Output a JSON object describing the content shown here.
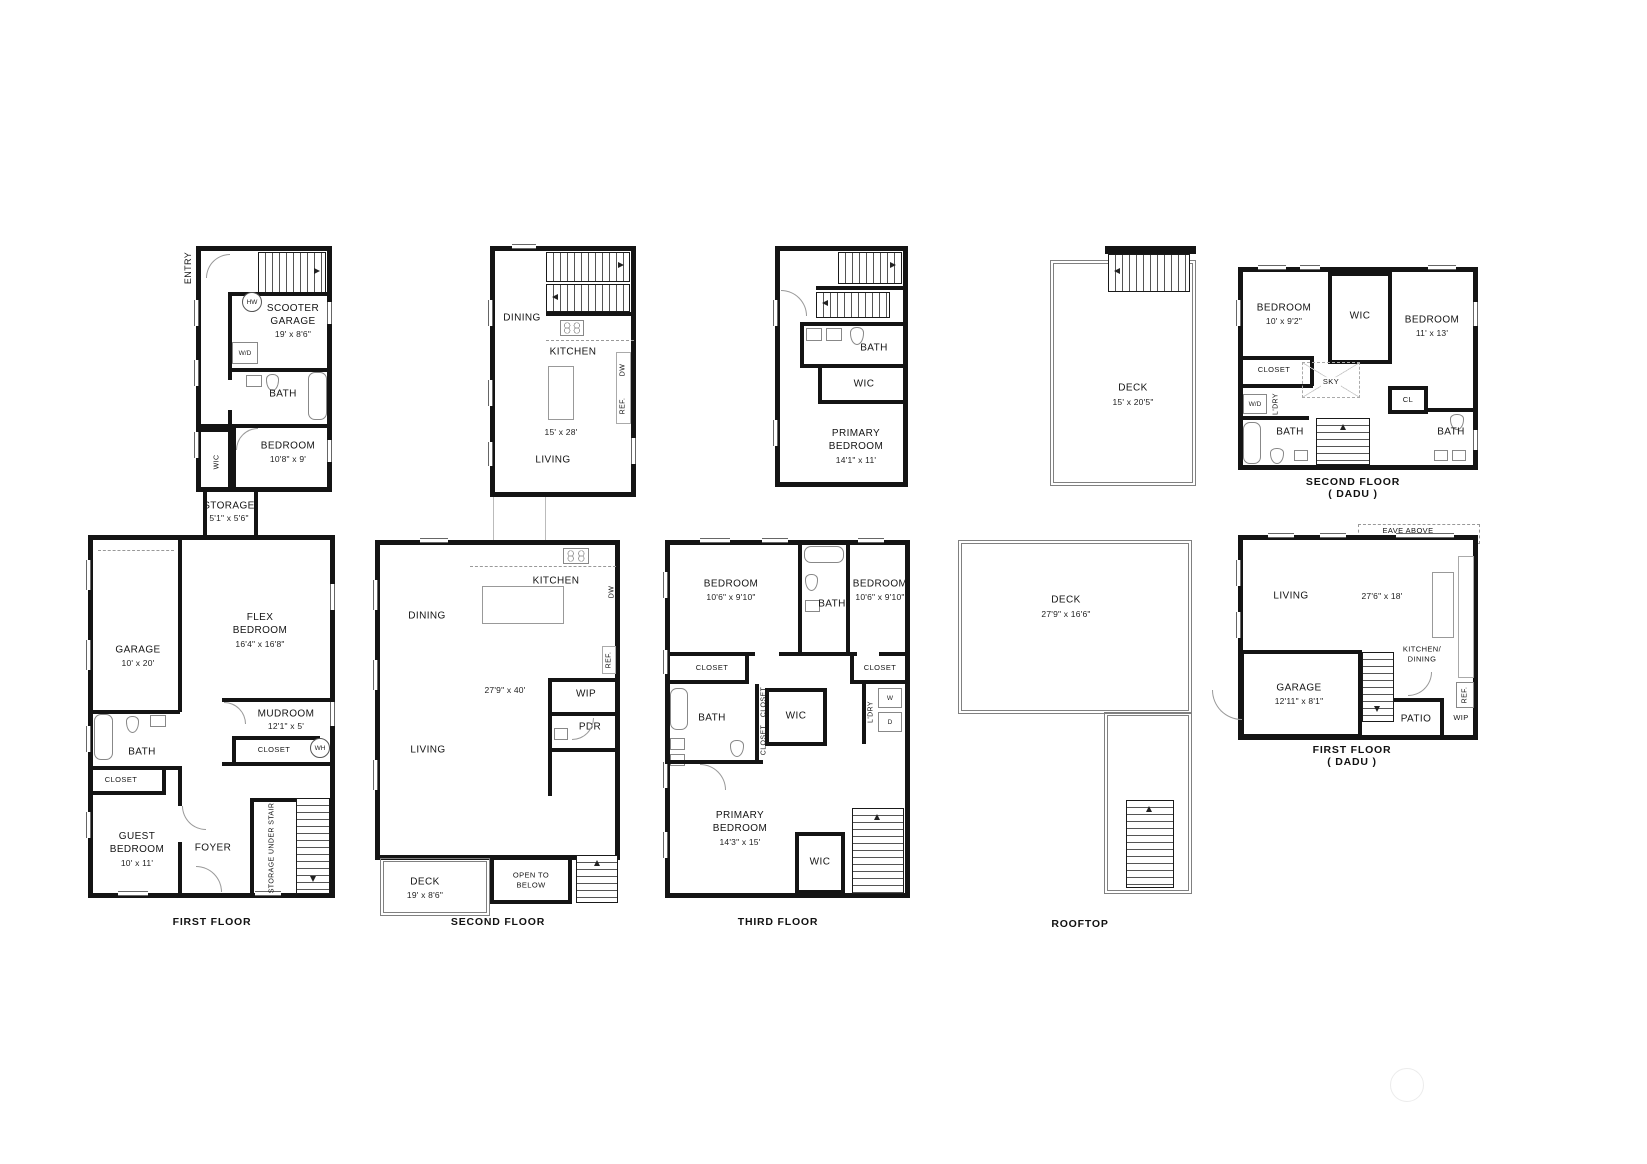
{
  "style": {
    "paper": "#ffffff",
    "ink": "#141414"
  },
  "plans": {
    "first_floor": {
      "caption": "FIRST FLOOR",
      "entry": "ENTRY",
      "hw": "HW",
      "scooter_garage": "SCOOTER GARAGE",
      "scooter_garage_dim": "19' x 8'6\"",
      "wd": "W/D",
      "bath_upper": "BATH",
      "bedroom": "BEDROOM",
      "bedroom_dim": "10'8\" x 9'",
      "wic": "WIC",
      "storage": "STORAGE",
      "storage_dim": "5'1\" x 5'6\"",
      "garage": "GARAGE",
      "garage_dim": "10' x 20'",
      "flex_bedroom": "FLEX BEDROOM",
      "flex_bedroom_dim": "16'4\" x 16'8\"",
      "mudroom": "MUDROOM",
      "mudroom_dim": "12'1\" x 5'",
      "mudroom_closet": "CLOSET",
      "wh": "WH",
      "bath_lower": "BATH",
      "guest_closet": "CLOSET",
      "guest_bedroom": "GUEST BEDROOM",
      "guest_bedroom_dim": "10' x 11'",
      "foyer": "FOYER",
      "storage_under_stair": "STORAGE UNDER STAIR"
    },
    "second_floor": {
      "caption": "SECOND FLOOR",
      "upper": {
        "dining": "DINING",
        "kitchen": "KITCHEN",
        "dw": "DW",
        "ref": "REF.",
        "island_dim": "15' x 28'",
        "living": "LIVING"
      },
      "lower": {
        "kitchen": "KITCHEN",
        "dw": "DW",
        "ref": "REF.",
        "dining": "DINING",
        "area_dim": "27'9\" x 40'",
        "wip": "WIP",
        "pdr": "PDR",
        "living": "LIVING",
        "open_to_below": "OPEN TO BELOW",
        "deck": "DECK",
        "deck_dim": "19' x 8'6\""
      }
    },
    "third_floor": {
      "caption": "THIRD FLOOR",
      "upper": {
        "bath": "BATH",
        "wic": "WIC",
        "primary_bedroom": "PRIMARY BEDROOM",
        "primary_bedroom_dim": "14'1\" x 11'"
      },
      "lower": {
        "bedroom_left": "BEDROOM",
        "bedroom_left_dim": "10'6\" x 9'10\"",
        "bath_top": "BATH",
        "bedroom_right": "BEDROOM",
        "bedroom_right_dim": "10'6\" x 9'10\"",
        "closet_left": "CLOSET",
        "closet_right": "CLOSET",
        "closet_v1": "CLOSET",
        "closet_v2": "CLOSET",
        "laundry": "L'DRY",
        "washer": "W",
        "dryer": "D",
        "bath_left": "BATH",
        "wic_mid": "WIC",
        "primary_bedroom": "PRIMARY BEDROOM",
        "primary_bedroom_dim": "14'3\" x 15'",
        "wic_bottom": "WIC"
      }
    },
    "rooftop": {
      "caption": "ROOFTOP",
      "upper_deck": "DECK",
      "upper_deck_dim": "15' x 20'5\"",
      "lower_deck": "DECK",
      "lower_deck_dim": "27'9\" x 16'6\""
    },
    "dadu_second": {
      "caption": "SECOND FLOOR",
      "caption2": "( DADU )",
      "bedroom_left": "BEDROOM",
      "bedroom_left_dim": "10' x 9'2\"",
      "wic": "WIC",
      "bedroom_right": "BEDROOM",
      "bedroom_right_dim": "11' x 13'",
      "closet": "CLOSET",
      "sky": "SKY",
      "wd": "W/D",
      "laundry": "L'DRY",
      "bath_left": "BATH",
      "cl": "CL",
      "bath_right": "BATH"
    },
    "dadu_first": {
      "caption": "FIRST FLOOR",
      "caption2": "( DADU )",
      "eave": "EAVE ABOVE",
      "living": "LIVING",
      "living_dim": "27'6\" x 18'",
      "dw": "DW",
      "kitchen_dining": "KITCHEN/ DINING",
      "ref": "REF.",
      "hw": "HW",
      "garage": "GARAGE",
      "garage_dim": "12'11\" x 8'1\"",
      "patio": "PATIO",
      "wip": "WIP"
    }
  }
}
